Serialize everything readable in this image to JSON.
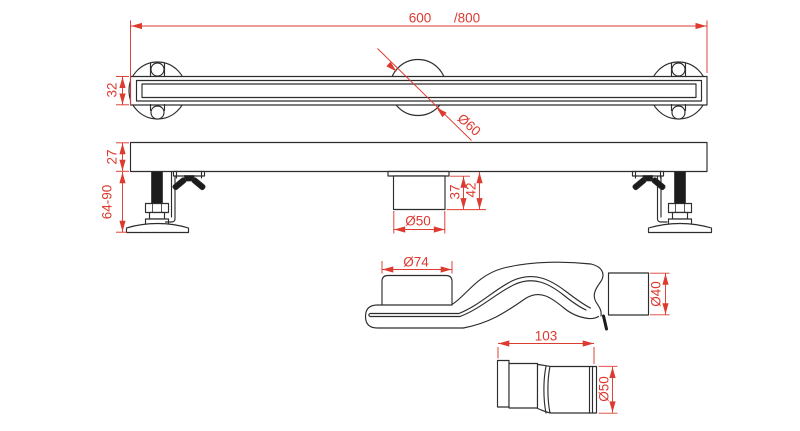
{
  "colors": {
    "line": "#2d2d2d",
    "dimension": "#dd3a30",
    "dark": "#1c1c1c",
    "background": "#ffffff"
  },
  "views": {
    "top_view": {
      "labels": {
        "length": "600",
        "length_alt": "/800",
        "channel_height": "32",
        "grate_circle_diameter": "Ø60"
      }
    },
    "side_view": {
      "labels": {
        "body_height": "27",
        "foot_adjust_range": "64-90",
        "outlet_height_partial": "37",
        "outlet_height_total": "42",
        "outlet_pipe_diameter": "Ø50"
      }
    },
    "siphon_view": {
      "labels": {
        "inlet_diameter": "Ø74",
        "outlet_diameter": "Ø40"
      }
    },
    "connector_view": {
      "labels": {
        "length": "103",
        "diameter": "Ø50"
      }
    }
  }
}
